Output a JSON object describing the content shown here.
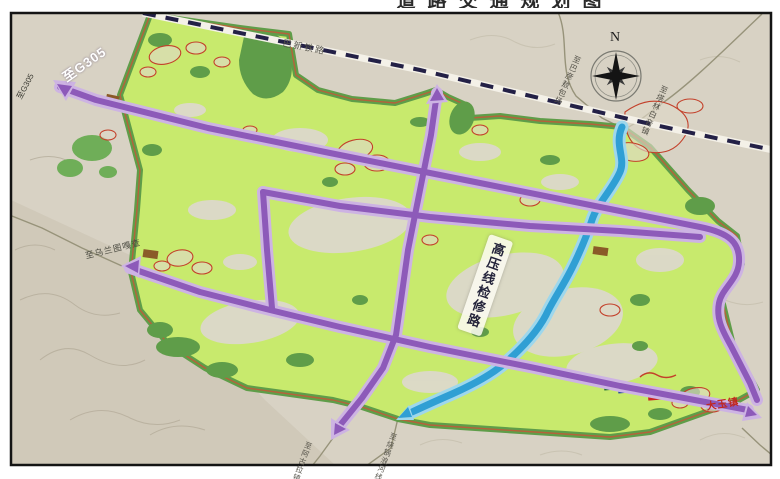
{
  "title": {
    "text": "道路交通规划图"
  },
  "compass": {
    "north": "N"
  },
  "labels": {
    "g305_main": "至G305",
    "g305_small": "至G305",
    "railway": "巴新铁路",
    "road_ne_west": "至巴彦敖包场",
    "road_ne_east": "至塔林白音镇",
    "road_west": "至乌兰图嘎查",
    "power_corridor": "高压线检修路",
    "exit_south_road": "至阿古拉镇",
    "exit_south_river": "至烧锅浪河线",
    "village": "大玉镇"
  },
  "colors": {
    "road-purple": "#8d5ab9",
    "road-casing": "#cdb3e3",
    "river-blue": "#2f9fd4",
    "river-casing": "#9ed7ec",
    "area-green": "#c8ea6d",
    "area-dark-green": "#5f9d49",
    "boundary-red": "#b5623b",
    "railway-dash": "#232046",
    "marker-red": "#c3402a",
    "terrain-gray": "#d8d2c4"
  }
}
